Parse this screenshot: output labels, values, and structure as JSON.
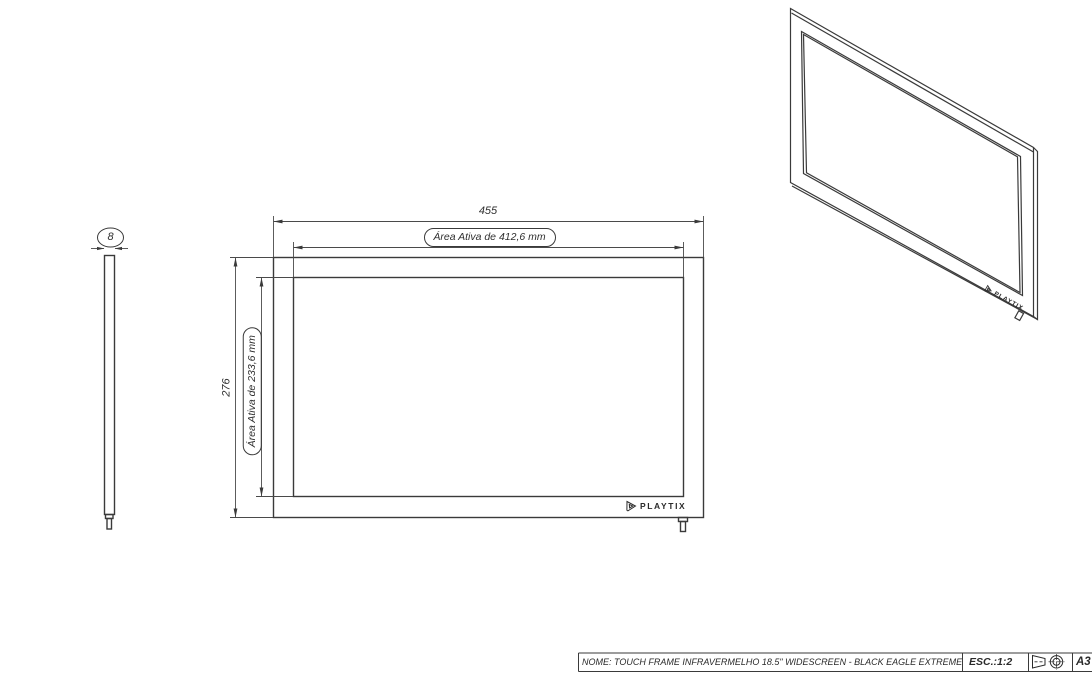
{
  "colors": {
    "line": "#3a3a3a",
    "background": "#ffffff"
  },
  "side_view": {
    "thickness_dim": "8"
  },
  "front_view": {
    "width_dim": "455",
    "height_dim": "276",
    "active_width_label": "Área Ativa de 412,6 mm",
    "active_height_label": "Área Ativa de 233,6 mm",
    "logo_text": "PLAYTIX"
  },
  "iso_view": {
    "logo_text": "PLAYTIX"
  },
  "title_block": {
    "name_label": "NOME: TOUCH FRAME INFRAVERMELHO 18.5\" WIDESCREEN - BLACK EAGLE EXTREME",
    "scale_label": "ESC.:1:2",
    "sheet_label": "A3"
  }
}
